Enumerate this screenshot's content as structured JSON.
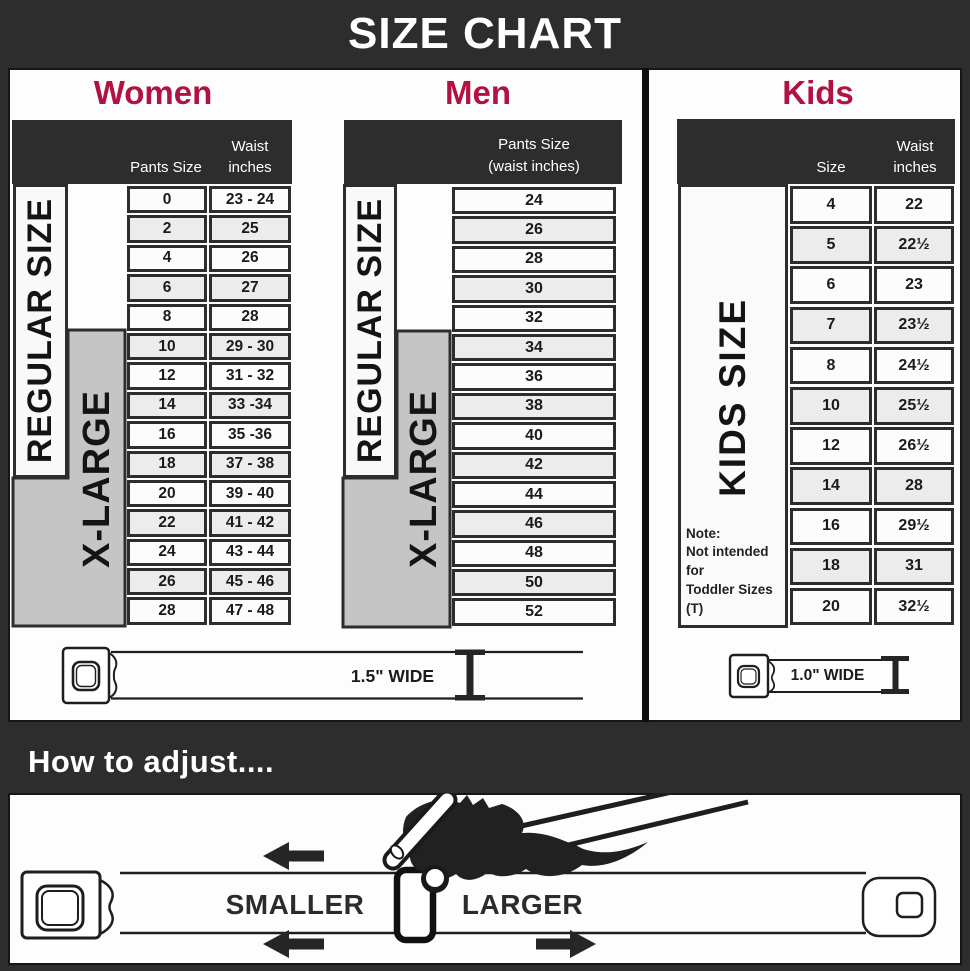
{
  "page": {
    "title": "SIZE CHART"
  },
  "colors": {
    "accent": "#b11242",
    "dark": "#2d2d2d",
    "row_alt": "#ececec",
    "xlarge_gray": "#c5c5c5"
  },
  "women": {
    "title": "Women",
    "header": {
      "col1": "Pants Size",
      "col2_line1": "Waist",
      "col2_line2": "inches"
    },
    "regular_label": "REGULAR SIZE",
    "xlarge_label": "X-LARGE",
    "rows": [
      {
        "size": "0",
        "waist": "23 - 24"
      },
      {
        "size": "2",
        "waist": "25"
      },
      {
        "size": "4",
        "waist": "26"
      },
      {
        "size": "6",
        "waist": "27"
      },
      {
        "size": "8",
        "waist": "28"
      },
      {
        "size": "10",
        "waist": "29 - 30"
      },
      {
        "size": "12",
        "waist": "31 - 32"
      },
      {
        "size": "14",
        "waist": "33 -34"
      },
      {
        "size": "16",
        "waist": "35 -36"
      },
      {
        "size": "18",
        "waist": "37 - 38"
      },
      {
        "size": "20",
        "waist": "39 - 40"
      },
      {
        "size": "22",
        "waist": "41 - 42"
      },
      {
        "size": "24",
        "waist": "43 - 44"
      },
      {
        "size": "26",
        "waist": "45 - 46"
      },
      {
        "size": "28",
        "waist": "47 - 48"
      }
    ]
  },
  "men": {
    "title": "Men",
    "header": {
      "line1": "Pants Size",
      "line2": "(waist inches)"
    },
    "regular_label": "REGULAR SIZE",
    "xlarge_label": "X-LARGE",
    "rows": [
      "24",
      "26",
      "28",
      "30",
      "32",
      "34",
      "36",
      "38",
      "40",
      "42",
      "44",
      "46",
      "48",
      "50",
      "52"
    ]
  },
  "kids": {
    "title": "Kids",
    "header": {
      "col1": "Size",
      "col2_line1": "Waist",
      "col2_line2": "inches"
    },
    "side_label": "KIDS SIZE",
    "note_line1": "Note:",
    "note_line2": "Not intended for",
    "note_line3": "Toddler Sizes (T)",
    "rows": [
      {
        "size": "4",
        "waist": "22"
      },
      {
        "size": "5",
        "waist": "22½"
      },
      {
        "size": "6",
        "waist": "23"
      },
      {
        "size": "7",
        "waist": "23½"
      },
      {
        "size": "8",
        "waist": "24½"
      },
      {
        "size": "10",
        "waist": "25½"
      },
      {
        "size": "12",
        "waist": "26½"
      },
      {
        "size": "14",
        "waist": "28"
      },
      {
        "size": "16",
        "waist": "29½"
      },
      {
        "size": "18",
        "waist": "31"
      },
      {
        "size": "20",
        "waist": "32½"
      }
    ]
  },
  "belts": {
    "adult_label": "1.5\" WIDE",
    "kids_label": "1.0\" WIDE"
  },
  "adjust": {
    "title": "How to adjust....",
    "smaller": "SMALLER",
    "larger": "LARGER"
  }
}
